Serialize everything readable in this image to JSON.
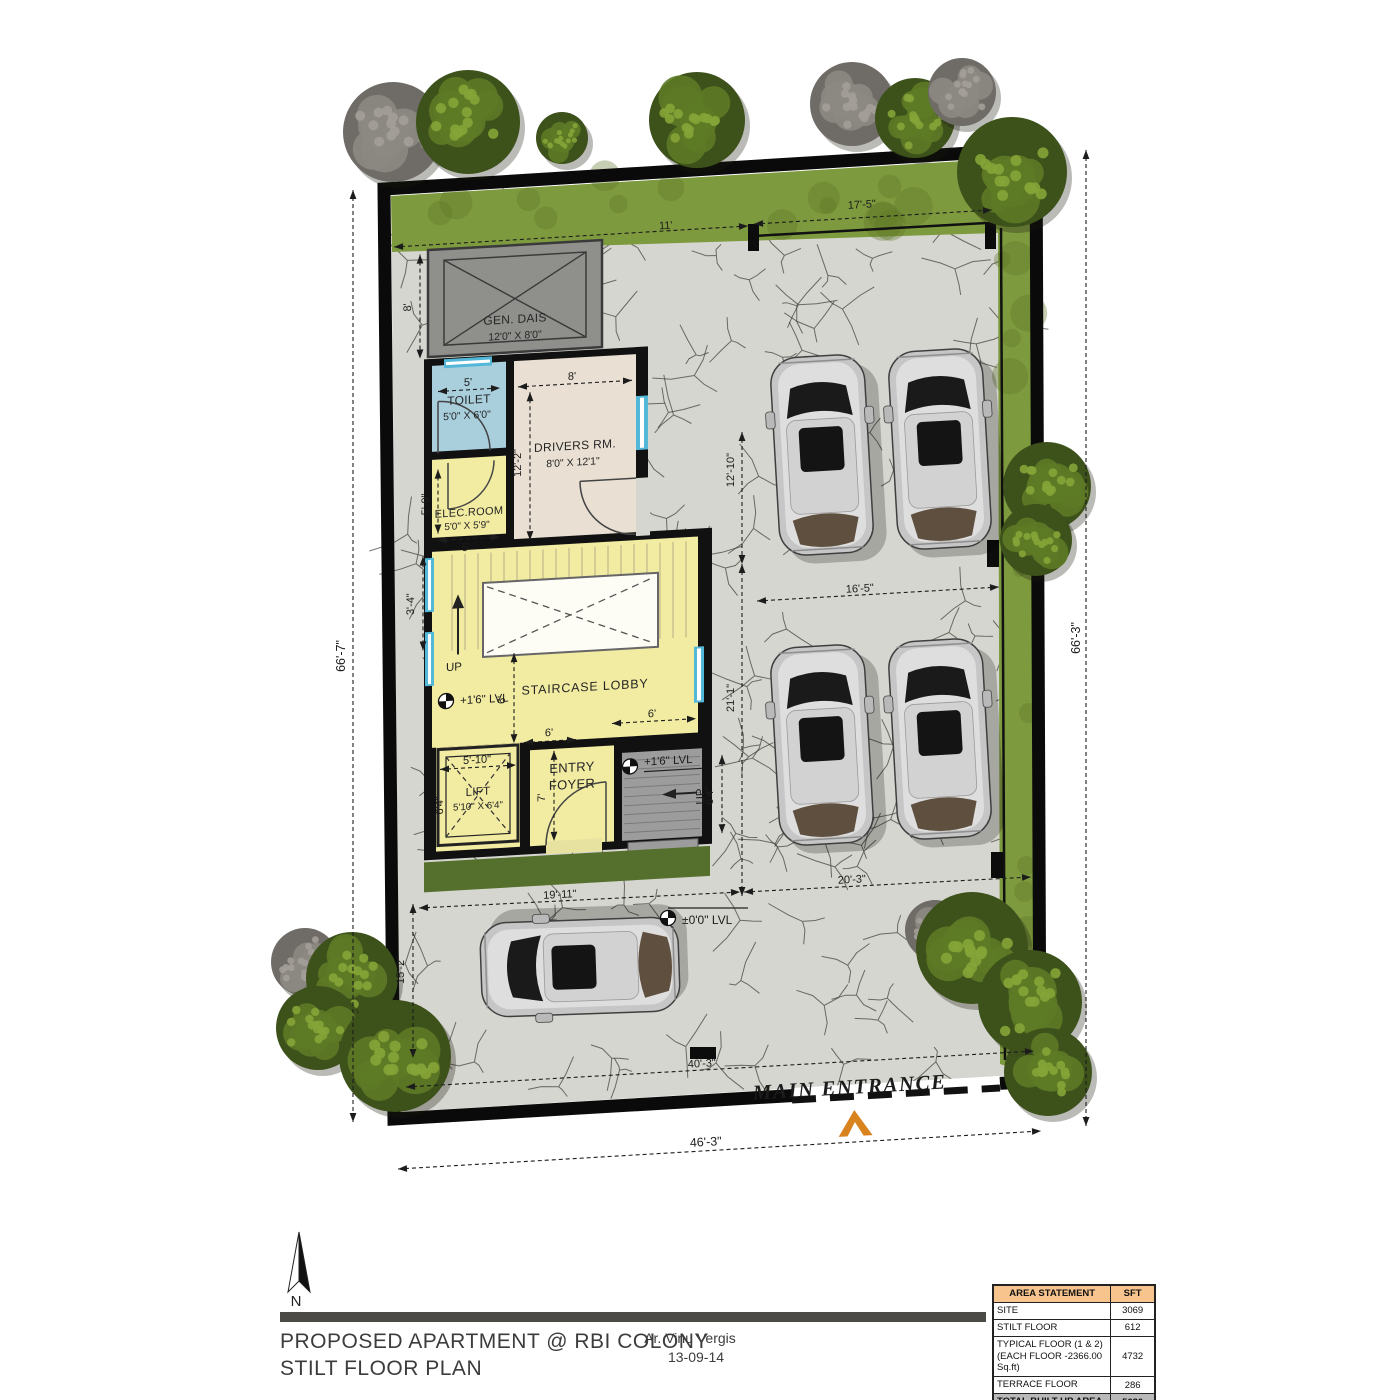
{
  "title_block": {
    "project_title": "PROPOSED APARTMENT @ RBI COLONY",
    "drawing_title": "STILT FLOOR PLAN",
    "architect": "Ar. Vinu Vergis",
    "date": "13-09-14"
  },
  "north_label": "N",
  "area_table": {
    "header": [
      "AREA STATEMENT",
      "SFT"
    ],
    "rows": [
      {
        "name": "SITE",
        "value": "3069"
      },
      {
        "name": "STILT FLOOR",
        "value": "612"
      },
      {
        "name": "TYPICAL FLOOR (1 & 2)\n(EACH FLOOR -2366.00 Sq.ft)",
        "value": "4732"
      },
      {
        "name": "TERRACE FLOOR",
        "value": "286"
      },
      {
        "name": "TOTAL BUILT-UP AREA",
        "value": "5630"
      }
    ]
  },
  "rooms": {
    "gen_dais": {
      "name": "GEN. DAIS",
      "size": "12'0\" X 8'0\""
    },
    "toilet": {
      "name": "TOILET",
      "size": "5'0\" X 6'0\""
    },
    "drivers_room": {
      "name": "DRIVERS RM.",
      "size": "8'0\" X 12'1\""
    },
    "elec_room": {
      "name": "ELEC.ROOM",
      "size": "5'0\" X 5'9\""
    },
    "staircase_lobby": {
      "name": "STAIRCASE LOBBY"
    },
    "lift": {
      "name": "LIFT",
      "size": "5'10\" X 6'4\""
    },
    "entry_foyer": {
      "name_line1": "ENTRY",
      "name_line2": "FOYER"
    }
  },
  "annotations": {
    "up_stair": "UP",
    "up_steps": "UP",
    "level_stair": "+1'6\" LVL",
    "level_steps": "+1'6\" LVL",
    "level_zero": "±0'0\" LVL",
    "main_entrance": "MAIN ENTRANCE"
  },
  "dimensions": {
    "site_left": "66'-7\"",
    "site_right": "66'-3\"",
    "site_bottom": "46'-3\"",
    "top_left_seg": "11'",
    "top_right_seg": "17'-5\"",
    "paving_upper": "12'-10\"",
    "paving_lower": "21'-1\"",
    "parking_gap": "16'-5\"",
    "bottom_left_seg": "19'-11\"",
    "bottom_right_seg": "20'-3\"",
    "entrance_width": "40'-3\"",
    "drive_left": "15'-2\"",
    "dais_height": "8'",
    "window_seg": "3'-4\"",
    "toilet_width": "5'",
    "drivers_width": "8'",
    "drivers_height": "12'-2\"",
    "elec_height": "5'-9\"",
    "elec_width": "5'",
    "stair_v": "6'",
    "stair_h": "6'",
    "foyer_w": "6'",
    "lift_w": "5'-10\"",
    "lift_side": "6'4\"",
    "foyer_h": "7'",
    "steps_h": "6'4\""
  },
  "colors": {
    "paving": "#d6d6d0",
    "grass": "#7e9a3e",
    "grass_dark": "#55702c",
    "room_yellow": "#f2eba2",
    "room_beige": "#e9dfd2",
    "room_blue": "#a9cfdd",
    "dais_grey": "#8f8f8c",
    "steps_grey": "#9c9c9c",
    "wall": "#111111",
    "window_cyan": "#53b7d8",
    "entrance_arrow": "#d9831f",
    "table_header": "#f7c48e",
    "table_total": "#b9b9b9",
    "car_body": "#c6c6c6"
  }
}
